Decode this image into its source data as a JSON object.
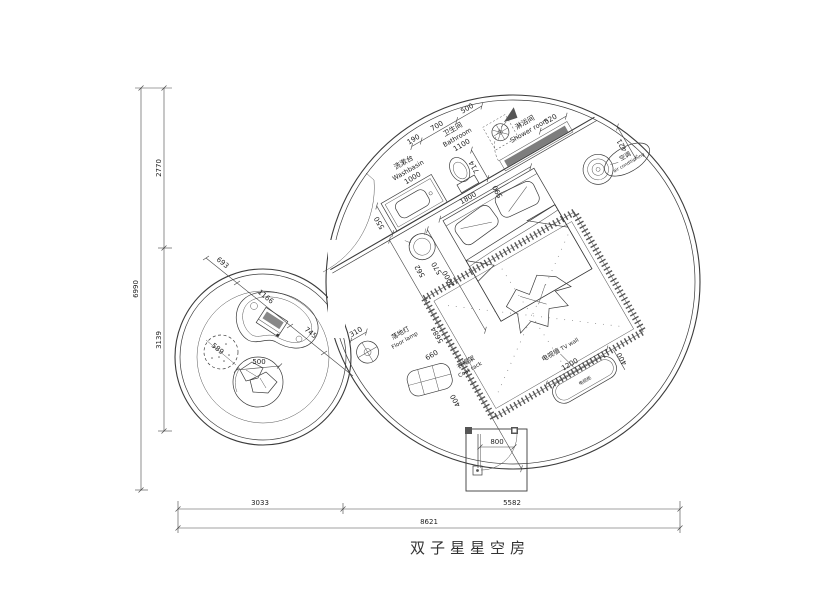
{
  "title": "双子星星空房",
  "labels": {
    "washbasin": {
      "zh": "洗漱台",
      "en": "Washbasin",
      "dim": "1000"
    },
    "bathroom": {
      "zh": "卫生间",
      "en": "Bathroom",
      "dim": "1100"
    },
    "shower_room": {
      "zh": "淋浴间",
      "en": "Shower room"
    },
    "air_conditioner": {
      "zh": "空调",
      "en": "air conditioning"
    },
    "floor_lamp": {
      "zh": "落地灯",
      "en": "Floor lamp"
    },
    "coat_rack": {
      "zh": "衣帽架",
      "en": "Coat rack"
    },
    "tv_wall": {
      "zh": "电视墙",
      "en": "TV wall"
    },
    "tv_cabinet": {
      "zh": "电视柜"
    }
  },
  "dims": {
    "overall_width": "8621",
    "overall_height": "6990",
    "bottom_left": "3033",
    "bottom_right": "5582",
    "left_upper": "2770",
    "left_lower": "3139",
    "top_a": "190",
    "top_b": "700",
    "top_c": "500",
    "shower_bench": "520",
    "ac_offset": "421",
    "wall_gap": "590",
    "toilet": "714",
    "bed_width": "1800",
    "vanity_depth": "550",
    "stool_a": "562",
    "stool_b": "570",
    "bed_length": "2000",
    "room_diag": "5684",
    "entry_door": "800",
    "floor_lamp": "310",
    "coat_rack_w": "660",
    "coat_rack_d": "400",
    "tv_w": "1200",
    "tv_d": "400",
    "lounge_a": "693",
    "lounge_b": "1166",
    "lounge_c": "745",
    "pouf": "589",
    "chair": "500"
  }
}
